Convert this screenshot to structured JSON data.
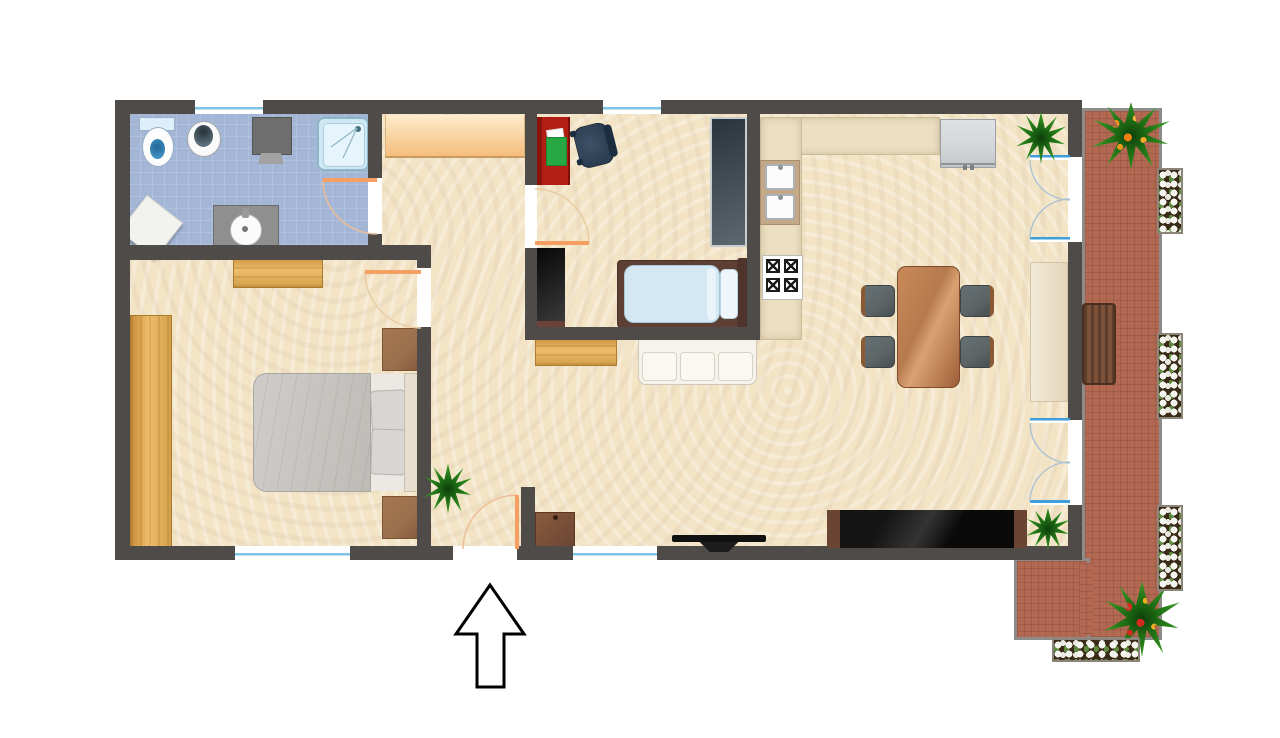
{
  "document": {
    "type": "apartment-floor-plan",
    "view": "top-down",
    "entrance_symbol": "arrow",
    "entrance_direction": "up"
  },
  "colors": {
    "wall": "#4f4b49",
    "floor_main": "#f3e4c6",
    "floor_bathroom": "#a4b6d6",
    "floor_balcony": "#b26851",
    "brick_border": "#8f8b88",
    "counter": "#ecdfc2",
    "closet_top": "#fdeccb",
    "closet_bottom": "#f5bd7d",
    "door_swing": "#f59f63",
    "window_glass": "#7ec3e8",
    "french_door_glass": "#3f9fdb",
    "desk_red": "#b21d14",
    "book_green": "#27a844",
    "office_chair": "#2c3e52",
    "wood_light": "#e2a94f",
    "wood_medium": "#9a6f4e",
    "wood_dark": "#6a4534",
    "sofa_white": "#f6f3ec",
    "table_brown": "#b57a4e",
    "chair_grey": "#5c6466",
    "bed_grey": "#c9c7c3",
    "single_bed_blue": "#d3e8f3",
    "appliance_grey": "#d3d6d8",
    "media_black": "#141414",
    "plant_green": "#2f8c1e",
    "flower_white": "#f5f5f0",
    "flower_orange": "#f0941e",
    "flower_red": "#d42a1e"
  },
  "openings": {
    "windows": 4,
    "french_doors_to_balcony": 2,
    "interior_doors": 3,
    "entry_doors": 1
  },
  "rooms": [
    {
      "name": "bathroom",
      "floor": "blue-tile",
      "furniture": [
        "toilet",
        "bidet",
        "washing-machine",
        "shower",
        "vanity-sink",
        "bath-mat"
      ]
    },
    {
      "name": "hallway",
      "floor": "beige",
      "furniture": [
        "built-in-closet",
        "entry-cabinet"
      ]
    },
    {
      "name": "bedroom",
      "floor": "beige",
      "furniture": [
        "double-bed",
        "wardrobe",
        "dresser",
        "nightstand-north",
        "nightstand-south"
      ]
    },
    {
      "name": "study-bedroom",
      "floor": "beige",
      "furniture": [
        "desk",
        "desk-chair",
        "tall-wardrobe",
        "black-closet",
        "single-bed"
      ]
    },
    {
      "name": "kitchen-living-room",
      "floor": "beige",
      "furniture": [
        "kitchen-counter",
        "double-sink",
        "stove",
        "refrigerator",
        "dining-table",
        "dining-chair",
        "dining-chair",
        "dining-chair",
        "dining-chair",
        "sofa",
        "sideboard",
        "display-cabinet",
        "media-cabinet",
        "tv",
        "potted-plant",
        "potted-plant",
        "potted-plant"
      ]
    },
    {
      "name": "balcony",
      "floor": "brick-tile",
      "furniture": [
        "bench",
        "flowering-plant",
        "flowering-plant",
        "flower-box",
        "flower-box",
        "flower-box",
        "flower-box"
      ]
    }
  ]
}
